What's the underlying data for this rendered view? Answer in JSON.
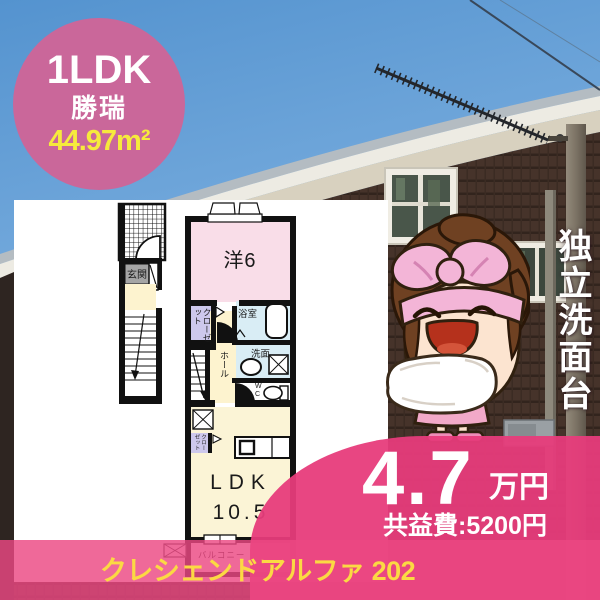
{
  "badge": {
    "layout": "1LDK",
    "area_name": "勝瑞",
    "size": "44.97m²"
  },
  "feature": {
    "label": "独立洗面台"
  },
  "floorplan": {
    "labels": {
      "entrance": "玄関",
      "western_room": "洋6",
      "closet_upper": "クローゼット",
      "bathroom": "浴室",
      "washroom": "洗面",
      "hall": "ホール",
      "toilet": "WC",
      "closet_lower": "クローゼット",
      "living": "LDK",
      "living_size": "10.5",
      "balcony": "バルコニー"
    }
  },
  "price": {
    "rent": "4.7",
    "rent_unit": "万円",
    "common_fee": "共益費:5200円"
  },
  "footer": {
    "building_name": "クレシェンドアルファ 202"
  },
  "colors": {
    "badge_pink": "#ca679a",
    "panel_pink": "#e73c7b",
    "bar_pink": "#ec4882",
    "size_yellow": "#f6ea3c",
    "footer_yellow": "#fbd943",
    "room_pink": "#f9dde8",
    "room_yellow": "#fdf3cf",
    "room_blue": "#d9edf5",
    "room_lavender": "#cdc8ec"
  }
}
